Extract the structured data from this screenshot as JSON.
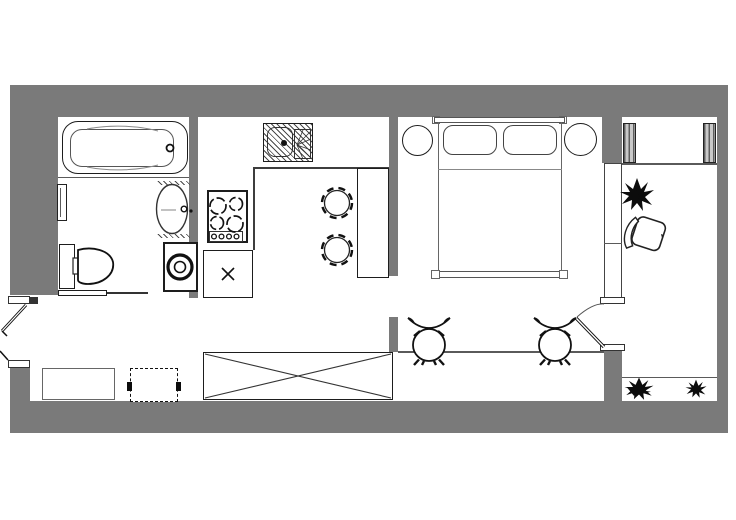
{
  "title": "studio-apartment-floor-plan",
  "colors": {
    "wall": "#7a7a7a",
    "outline": "#1d1d1d",
    "thin_line": "#5a5a5a",
    "background": "#ffffff",
    "ink": "#0c0c0c"
  },
  "drawing": {
    "kind": "top-down architectural floor plan, monochrome, no text labels",
    "rooms": [
      {
        "id": "bathroom",
        "fixtures": [
          "bathtub",
          "washbasin-oval",
          "vanity-niche",
          "toilet-with-cistern",
          "washing-machine",
          "towel-rail",
          "sliding-door"
        ]
      },
      {
        "id": "kitchen",
        "fixtures": [
          "sink-with-drainer-hatched",
          "cooktop-4-burners-with-knobs",
          "base-cabinet-x-marked",
          "counter-front-edge",
          "dining-table",
          "round-chair",
          "round-chair"
        ]
      },
      {
        "id": "bedroom",
        "fixtures": [
          "double-bed",
          "pillow",
          "pillow",
          "headboard",
          "nightstand-round",
          "nightstand-round",
          "swing-door-to-dressing"
        ]
      },
      {
        "id": "window-zone",
        "fixtures": [
          "wardrobe-x-marked",
          "window-bench",
          "dashed-cabinet",
          "bar-stool-vase",
          "bar-stool-vase",
          "bar-counter-edge"
        ]
      },
      {
        "id": "dressing-area",
        "fixtures": [
          "wardrobe-panel-striped",
          "wardrobe-panel-striped",
          "armchair-rotated",
          "plant",
          "plant",
          "plant",
          "window-ledge"
        ]
      },
      {
        "id": "entry",
        "fixtures": [
          "entrance-door-leaf",
          "secondary-door-leaf",
          "door-jamb",
          "door-jamb"
        ]
      }
    ]
  }
}
